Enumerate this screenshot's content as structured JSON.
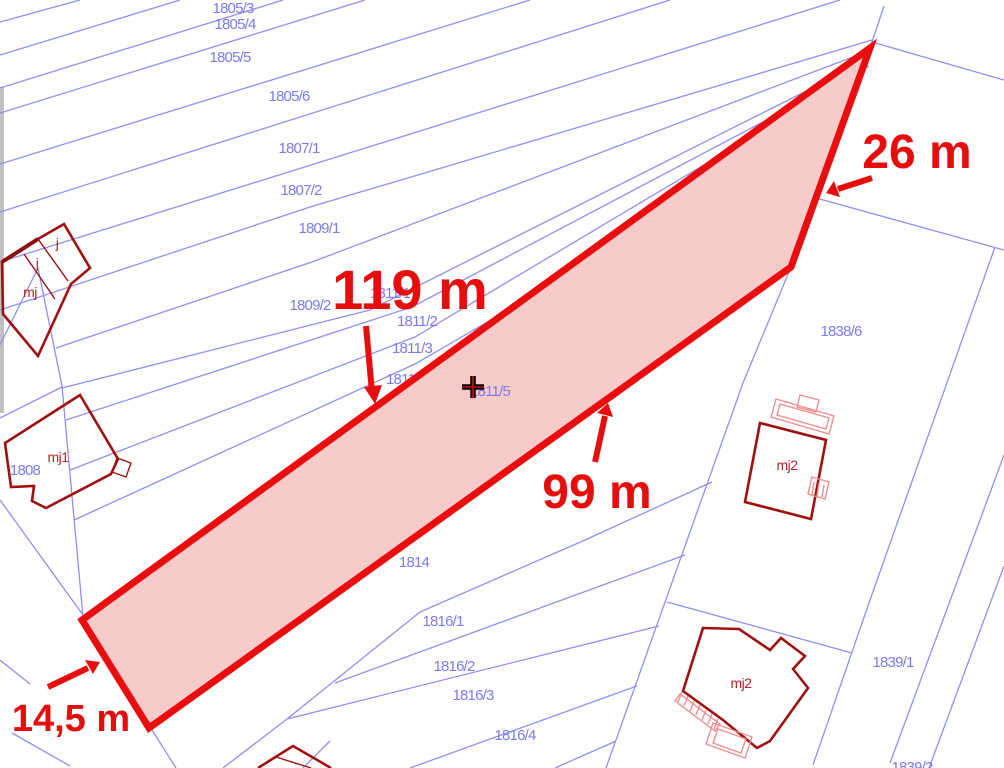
{
  "map": {
    "type": "cadastral-parcel-map",
    "highlighted_parcel": {
      "id": "1811/5",
      "fill_color": "#f8cbcb",
      "stroke_color": "#ea0d0d",
      "dimensions": {
        "side_ne": "26 m",
        "side_nw": "119 m",
        "side_se": "99 m",
        "side_sw": "14,5 m"
      }
    },
    "colors": {
      "parcel_line": "#8f8ff0",
      "parcel_label": "#7b7bee",
      "building_outline": "#a01010",
      "building_light": "#ef8f8f",
      "annotation": "#e60d0d",
      "edge_bar": "#c0c0c0",
      "background": "#ffffff"
    },
    "marker": {
      "symbol": "plus-cross",
      "color": "#000000",
      "parcel": "1811/5"
    },
    "parcel_labels": [
      {
        "text": "1805/3"
      },
      {
        "text": "1805/4"
      },
      {
        "text": "1805/5"
      },
      {
        "text": "1805/6"
      },
      {
        "text": "1807/1"
      },
      {
        "text": "1807/2"
      },
      {
        "text": "1809/1"
      },
      {
        "text": "1809/2"
      },
      {
        "text": "1811/1"
      },
      {
        "text": "1811/2"
      },
      {
        "text": "1811/3"
      },
      {
        "text": "1811/4"
      },
      {
        "text": "1811/5"
      },
      {
        "text": "1814"
      },
      {
        "text": "1816/1"
      },
      {
        "text": "1816/2"
      },
      {
        "text": "1816/3"
      },
      {
        "text": "1816/4"
      },
      {
        "text": "1838/6"
      },
      {
        "text": "1839/1"
      },
      {
        "text": "1839/2"
      },
      {
        "text": "1808"
      }
    ],
    "building_labels": [
      {
        "text": "j"
      },
      {
        "text": "j"
      },
      {
        "text": "mj"
      },
      {
        "text": "mj1"
      },
      {
        "text": "mj2"
      },
      {
        "text": "mj2"
      }
    ],
    "annotations": {
      "dim_26": "26 m",
      "dim_119": "119 m",
      "dim_99": "99 m",
      "dim_145": "14,5 m"
    }
  }
}
